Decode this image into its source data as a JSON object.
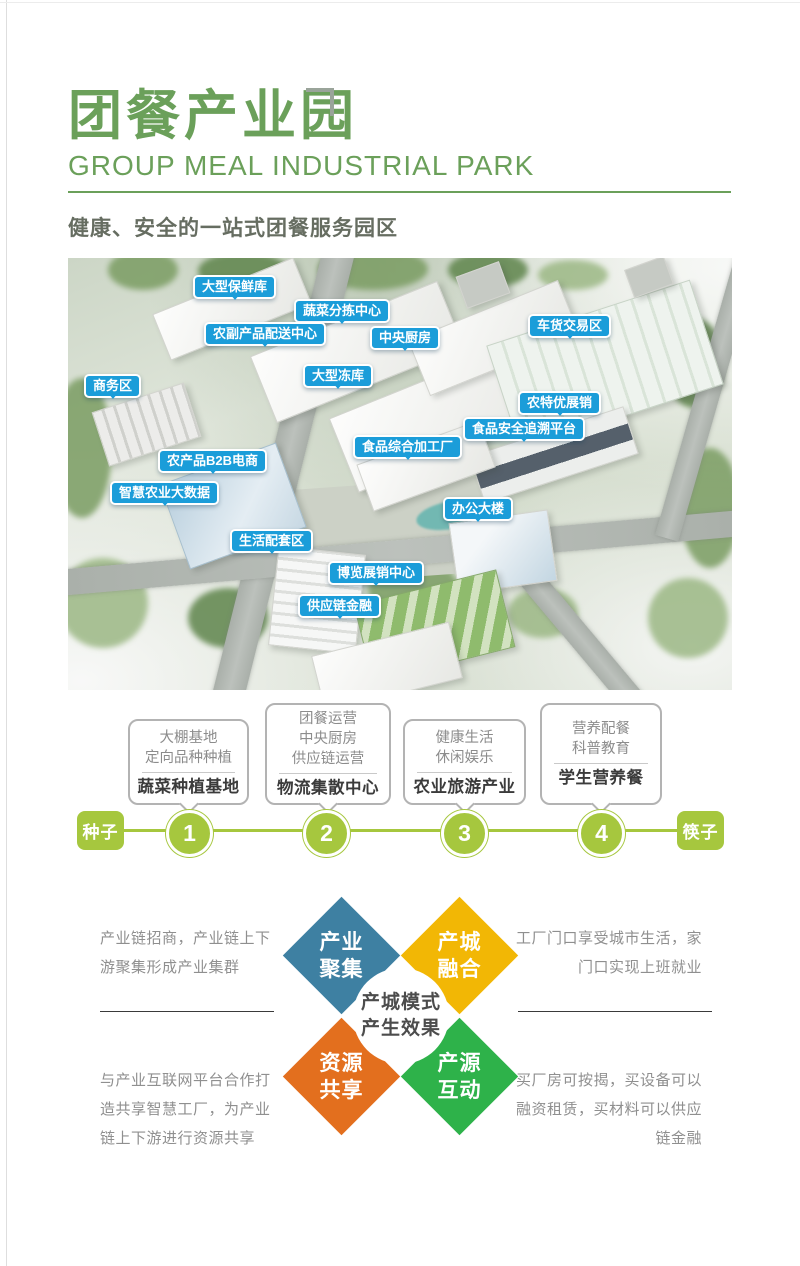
{
  "header": {
    "title": "团餐产业园",
    "subtitle_en": "GROUP MEAL INDUSTRIAL PARK",
    "tagline": "健康、安全的一站式团餐服务园区"
  },
  "park_map": {
    "labels": [
      {
        "text": "大型保鲜库"
      },
      {
        "text": "蔬菜分拣中心"
      },
      {
        "text": "农副产品配送中心"
      },
      {
        "text": "中央厨房"
      },
      {
        "text": "大型冻库"
      },
      {
        "text": "商务区"
      },
      {
        "text": "车货交易区"
      },
      {
        "text": "农特优展销"
      },
      {
        "text": "食品安全追溯平台"
      },
      {
        "text": "食品综合加工厂"
      },
      {
        "text": "农产品B2B电商"
      },
      {
        "text": "智慧农业大数据"
      },
      {
        "text": "办公大楼"
      },
      {
        "text": "生活配套区"
      },
      {
        "text": "博览展销中心"
      },
      {
        "text": "供应链金融"
      }
    ]
  },
  "timeline": {
    "start_label": "种子",
    "end_label": "筷子",
    "steps": [
      {
        "number": "1",
        "sub1": "大棚基地",
        "sub2": "定向品种种植",
        "title": "蔬菜种植基地"
      },
      {
        "number": "2",
        "sub1": "团餐运营",
        "sub2": "中央厨房",
        "sub3": "供应链运营",
        "title": "物流集散中心"
      },
      {
        "number": "3",
        "sub1": "健康生活",
        "sub2": "休闲娱乐",
        "title": "农业旅游产业"
      },
      {
        "number": "4",
        "sub1": "营养配餐",
        "sub2": "科普教育",
        "title": "学生营养餐"
      }
    ]
  },
  "effects": {
    "center_line1": "产城模式",
    "center_line2": "产生效果",
    "diamonds": [
      {
        "line1": "产业",
        "line2": "聚集",
        "color": "#3e80a2"
      },
      {
        "line1": "产城",
        "line2": "融合",
        "color": "#f2b705"
      },
      {
        "line1": "资源",
        "line2": "共享",
        "color": "#e36f1e"
      },
      {
        "line1": "产源",
        "line2": "互动",
        "color": "#2eb24a"
      }
    ],
    "notes": {
      "top_left": "产业链招商，产业链上下游聚集形成产业集群",
      "top_right": "工厂门口享受城市生活，家门口实现上班就业",
      "bottom_left": "与产业互联网平台合作打造共享智慧工厂，为产业链上下游进行资源共享",
      "bottom_right": "买厂房可按揭，买设备可以融资租赁，买材料可以供应链金融"
    }
  },
  "colors": {
    "brand_green": "#6ba05a",
    "timeline_green": "#a6c73e",
    "map_label_blue": "#1b9dd9",
    "diamond_blue": "#3e80a2",
    "diamond_yellow": "#f2b705",
    "diamond_orange": "#e36f1e",
    "diamond_green": "#2eb24a"
  }
}
